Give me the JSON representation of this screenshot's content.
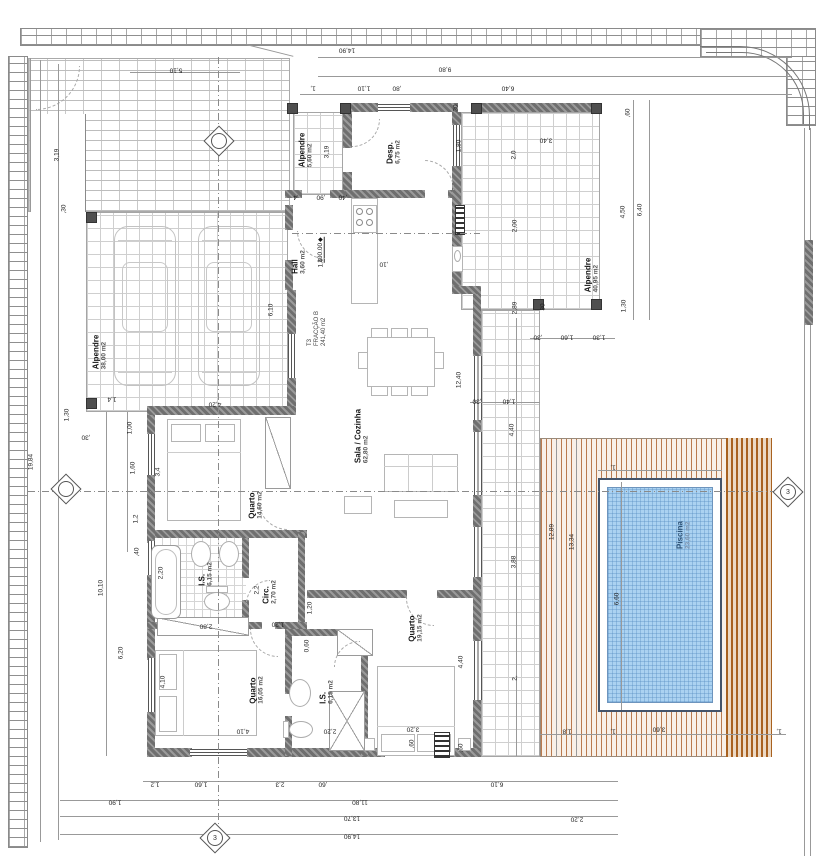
{
  "drawing": {
    "unit": {
      "type": "T3",
      "fraction": "FRACÇÃO B",
      "area": "241,40 m2"
    },
    "level_marker": "100.00",
    "rooms": [
      {
        "name": "Alpendre",
        "area": "38,00 m2",
        "x": 100,
        "y": 352
      },
      {
        "name": "Alpendre",
        "area": "5,60 m2",
        "x": 306,
        "y": 150
      },
      {
        "name": "Desp.",
        "area": "6,75 m2",
        "x": 394,
        "y": 152
      },
      {
        "name": "Hall",
        "area": "3,60 m2",
        "x": 299,
        "y": 262
      },
      {
        "name": "Sala / Cozinha",
        "area": "62,80 m2",
        "x": 362,
        "y": 436
      },
      {
        "name": "Quarto",
        "area": "14,60 m2",
        "x": 256,
        "y": 505
      },
      {
        "name": "I.S.",
        "area": "6,15 m2",
        "x": 206,
        "y": 574
      },
      {
        "name": "Circ.",
        "area": "2,70 m2",
        "x": 270,
        "y": 592
      },
      {
        "name": "Quarto",
        "area": "16,05 m2",
        "x": 257,
        "y": 690
      },
      {
        "name": "I.S.",
        "area": "6,15 m2",
        "x": 327,
        "y": 692
      },
      {
        "name": "Quarto",
        "area": "19,15 m2",
        "x": 416,
        "y": 628
      },
      {
        "name": "Alpendre",
        "area": "40,95 m2",
        "x": 592,
        "y": 275
      },
      {
        "name": "Piscina",
        "area": "23,60 m2",
        "x": 684,
        "y": 535,
        "blue": true
      }
    ],
    "dims": [
      [
        "14,90",
        347,
        50,
        180
      ],
      [
        "9,80",
        445,
        69,
        180
      ],
      [
        "1,",
        313,
        88,
        180
      ],
      [
        "1,10",
        364,
        88,
        180
      ],
      [
        ",80",
        397,
        88,
        180
      ],
      [
        "6,40",
        508,
        88,
        180
      ],
      [
        "5,10",
        176,
        70,
        180
      ],
      [
        "3,19",
        57,
        155,
        -90
      ],
      [
        ",30",
        64,
        209,
        -90
      ],
      [
        "19,84",
        31,
        462,
        -90
      ],
      [
        "10,10",
        101,
        588,
        -90
      ],
      [
        "6,20",
        121,
        653,
        -90
      ],
      [
        "6,10",
        271,
        310,
        -90
      ],
      [
        "1,30",
        67,
        415,
        -90
      ],
      [
        ",30",
        86,
        437,
        180
      ],
      [
        "1,4",
        112,
        399,
        180
      ],
      [
        "1,00",
        130,
        428,
        -90
      ],
      [
        "1,60",
        133,
        468,
        -90
      ],
      [
        "1,2",
        136,
        519,
        -90
      ],
      [
        ",40",
        137,
        552,
        -90
      ],
      [
        "3,4",
        158,
        472,
        -90
      ],
      [
        "2,20",
        161,
        573,
        -90
      ],
      [
        "2,2",
        257,
        590,
        -90
      ],
      [
        "4,10",
        163,
        682,
        -90
      ],
      [
        "4,10",
        243,
        731,
        180
      ],
      [
        "2,80",
        206,
        626,
        180
      ],
      [
        "1,20",
        278,
        624,
        180
      ],
      [
        "1,20",
        310,
        608,
        -90
      ],
      [
        "0,60",
        307,
        646,
        -90
      ],
      [
        "2,20",
        330,
        731,
        180
      ],
      [
        "3,20",
        413,
        729,
        180
      ],
      [
        "4,40",
        461,
        662,
        -90
      ],
      [
        "12,40",
        459,
        380,
        -90
      ],
      [
        "4,20",
        215,
        404,
        180
      ],
      [
        ",4",
        296,
        197,
        180
      ],
      [
        ",90",
        321,
        197,
        180
      ],
      [
        ",40",
        343,
        197,
        180
      ],
      [
        "1,6",
        321,
        263,
        -90
      ],
      [
        ",10",
        384,
        264,
        180
      ],
      [
        "3,19",
        327,
        152,
        -90
      ],
      [
        "1,80",
        459,
        146,
        -90
      ],
      [
        "30",
        456,
        108,
        -90
      ],
      [
        "2,0",
        514,
        155,
        -90
      ],
      [
        "2,00",
        515,
        226,
        -90
      ],
      [
        "2,89",
        515,
        308,
        -90
      ],
      [
        "3,40",
        546,
        140,
        180
      ],
      [
        "30",
        543,
        307,
        -90
      ],
      [
        ",30",
        538,
        337,
        180
      ],
      [
        "1,60",
        567,
        337,
        180
      ],
      [
        "1,30",
        599,
        337,
        180
      ],
      [
        ",30",
        477,
        401,
        180
      ],
      [
        "1,40",
        509,
        401,
        180
      ],
      [
        "4,40",
        512,
        430,
        -90
      ],
      [
        "3,88",
        514,
        562,
        -90
      ],
      [
        "2,",
        515,
        678,
        -90
      ],
      [
        ",60",
        628,
        113,
        -90
      ],
      [
        "4,50",
        623,
        212,
        -90
      ],
      [
        "6,40",
        640,
        210,
        -90
      ],
      [
        "1,30",
        624,
        306,
        -90
      ],
      [
        "12,89",
        552,
        532,
        -90
      ],
      [
        "13,34",
        572,
        542,
        -90
      ],
      [
        "6,60",
        617,
        599,
        -90
      ],
      [
        "1,",
        613,
        467,
        180
      ],
      [
        "1,8",
        567,
        731,
        180
      ],
      [
        "1,",
        613,
        731,
        180
      ],
      [
        "3,60",
        659,
        729,
        180
      ],
      [
        "1,",
        779,
        731,
        180
      ],
      [
        ",60",
        412,
        744,
        -90
      ],
      [
        ",60",
        461,
        748,
        -90
      ],
      [
        "6,10",
        497,
        784,
        180
      ],
      [
        "2,20",
        577,
        819,
        180
      ],
      [
        "1,2",
        155,
        784,
        180
      ],
      [
        "1,60",
        201,
        784,
        180
      ],
      [
        "2,3",
        280,
        784,
        180
      ],
      [
        ",60",
        323,
        784,
        180
      ],
      [
        "1,90",
        115,
        802,
        180
      ],
      [
        "11,80",
        360,
        802,
        180
      ],
      [
        "13,70",
        352,
        818,
        180
      ],
      [
        "14,90",
        352,
        836,
        180
      ]
    ],
    "markers": [
      {
        "x": 219,
        "y": 141,
        "label": ""
      },
      {
        "x": 66,
        "y": 489,
        "label": ""
      },
      {
        "x": 788,
        "y": 492,
        "label": "3"
      },
      {
        "x": 215,
        "y": 838,
        "label": "3"
      }
    ]
  }
}
